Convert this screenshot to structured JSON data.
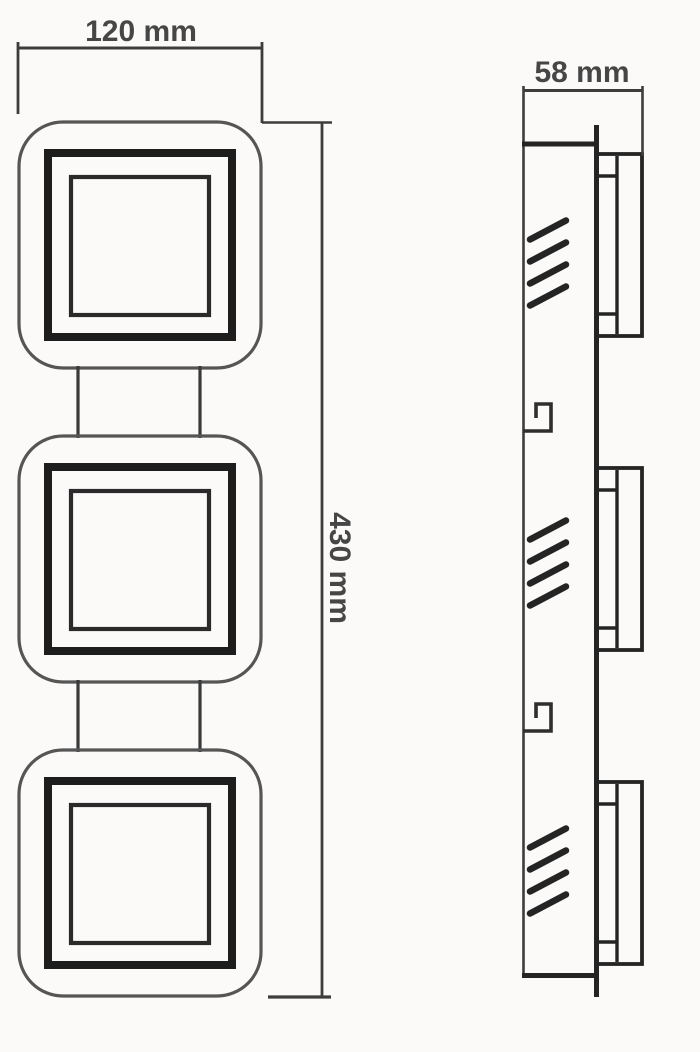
{
  "drawing": {
    "type": "technical-dimension-drawing",
    "subject": "three-square linear luminaire, orthographic front and side views",
    "dimensions": {
      "width_label": "120 mm",
      "height_label": "430 mm",
      "depth_label": "58 mm"
    },
    "views": {
      "front": {
        "name": "front-view",
        "module_count": 3
      },
      "side": {
        "name": "side-view",
        "module_count": 3,
        "hatch_groups": 3,
        "mount_hooks": 2
      }
    },
    "colors": {
      "background": "#fbfaf9",
      "line_thin": "#3d3d3d",
      "line_medium": "#2e2e2e",
      "line_heavy": "#1d1d1d",
      "outer_frame": "#555555",
      "text": "#464646"
    }
  }
}
